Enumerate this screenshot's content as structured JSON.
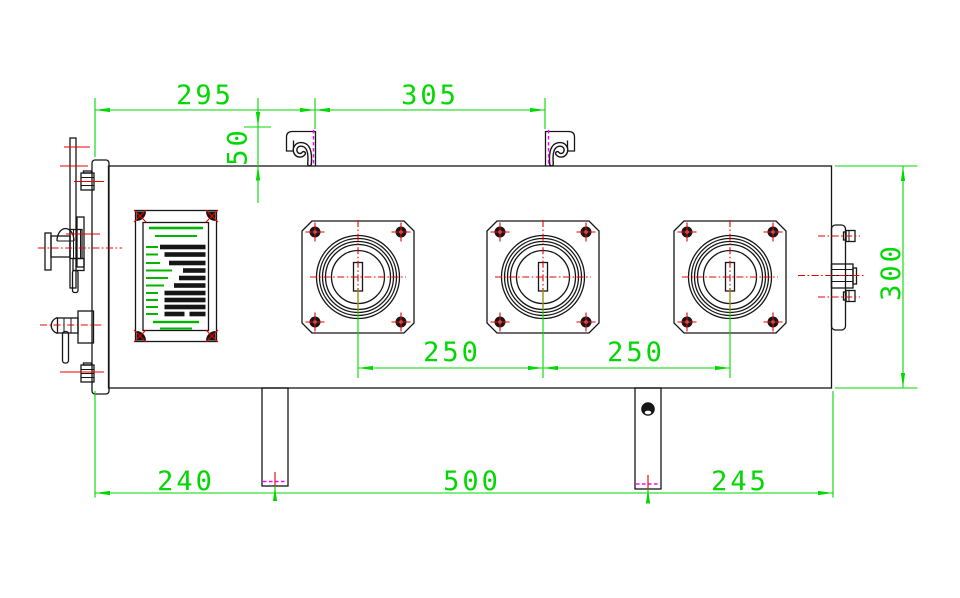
{
  "drawing": {
    "title": "",
    "dimensions": {
      "d295": "295",
      "d305": "305",
      "d50": "50",
      "d250a": "250",
      "d250b": "250",
      "d240": "240",
      "d500": "500",
      "d245": "245",
      "d300": "300"
    },
    "colors": {
      "background": "#ffffff",
      "outline": "#161616",
      "dimension": "#00d900",
      "centerline": "#e80000",
      "marker": "#ff00ff",
      "overlap": "#8b8b00",
      "npgreen": "#00b400"
    },
    "features": {
      "viewing_windows": 3,
      "lifting_hooks": 2,
      "mounting_legs": 2,
      "corner_bolts_per_window": 4,
      "nameplate_corner_fasteners": 4
    },
    "nameplate": {
      "title_lines": [
        {
          "y": 228,
          "w": 54,
          "h": 2.6
        },
        {
          "y": 236,
          "w": 42,
          "h": 2
        }
      ],
      "rows": [
        {
          "y": 247,
          "label_w": 12,
          "bars": [
            [
              160,
              45.5
            ]
          ]
        },
        {
          "y": 254.5,
          "label_w": 12,
          "bars": [
            [
              164.5,
              41
            ]
          ]
        },
        {
          "y": 263,
          "label_w": 14,
          "bars": [
            [
              169,
              36.5
            ]
          ]
        },
        {
          "y": 270.5,
          "label_w": 26,
          "bars": [
            [
              183,
              22.5
            ]
          ]
        },
        {
          "y": 278,
          "label_w": 22,
          "bars": [
            [
              179,
              26.5
            ]
          ]
        },
        {
          "y": 285.5,
          "label_w": 18,
          "bars": [
            [
              174,
              31.5
            ]
          ]
        },
        {
          "y": 293,
          "label_w": 12,
          "bars": [
            [
              164.5,
              41
            ]
          ]
        },
        {
          "y": 300,
          "label_w": 12,
          "bars": [
            [
              164.5,
              41
            ]
          ]
        },
        {
          "y": 307,
          "label_w": 12,
          "bars": [
            [
              164.5,
              41
            ]
          ]
        },
        {
          "y": 314,
          "label_w": 12,
          "bars": [
            [
              164.5,
              20
            ],
            [
              189.5,
              16
            ]
          ]
        }
      ],
      "footer_lines": [
        {
          "y": 322,
          "w": 46,
          "h": 2.4
        },
        {
          "y": 328.5,
          "w": 32,
          "h": 2
        }
      ]
    }
  }
}
